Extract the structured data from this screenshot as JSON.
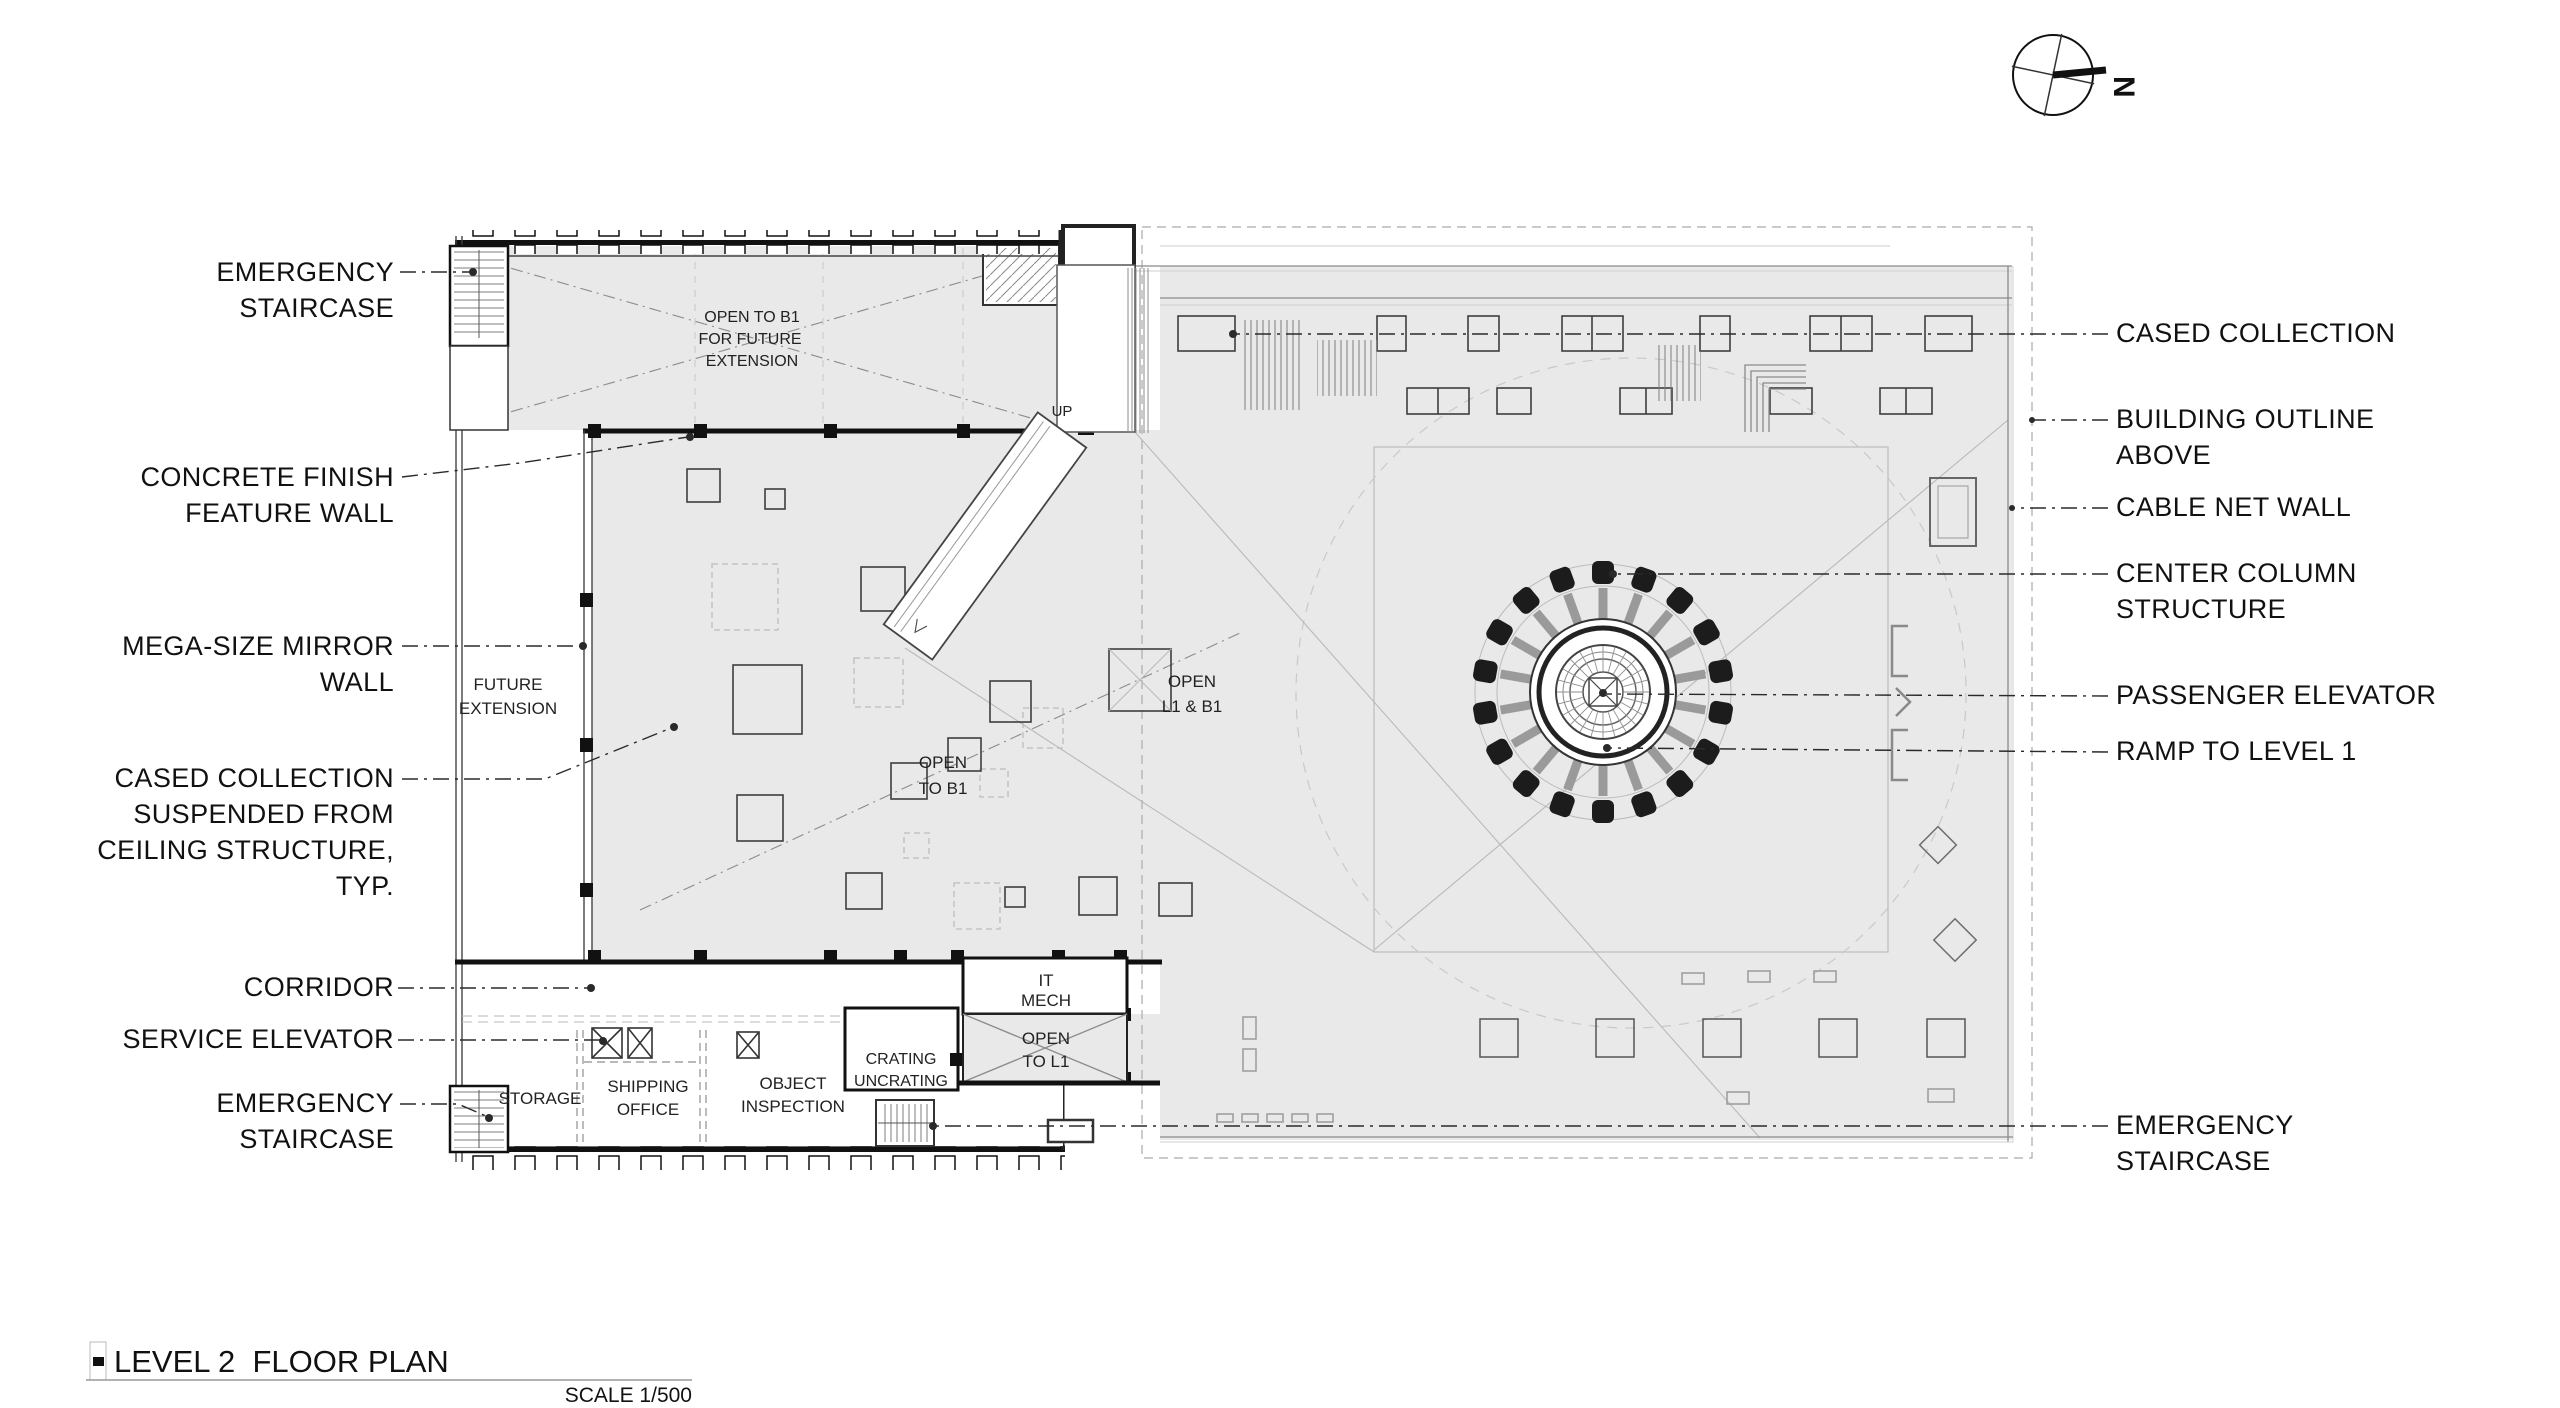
{
  "drawing": {
    "title": "LEVEL 2  FLOOR PLAN",
    "scale_label": "SCALE 1/500",
    "compass": {
      "north_letter": "N"
    }
  },
  "colors": {
    "wall": "#111111",
    "gray": "#e9e9e9",
    "leader": "#2a2a2a",
    "light": "#bbbbbb",
    "text": "#111111"
  },
  "labels": {
    "left": [
      {
        "id": "emergency-staircase-top",
        "lines": [
          "EMERGENCY",
          "STAIRCASE"
        ]
      },
      {
        "id": "concrete-finish-feature-wall",
        "lines": [
          "CONCRETE FINISH",
          "FEATURE WALL"
        ]
      },
      {
        "id": "mega-size-mirror-wall",
        "lines": [
          "MEGA-SIZE MIRROR",
          "WALL"
        ]
      },
      {
        "id": "cased-collection-suspended",
        "lines": [
          "CASED COLLECTION",
          "SUSPENDED FROM",
          "CEILING STRUCTURE,",
          "TYP."
        ]
      },
      {
        "id": "corridor",
        "lines": [
          "CORRIDOR"
        ]
      },
      {
        "id": "service-elevator",
        "lines": [
          "SERVICE ELEVATOR"
        ]
      },
      {
        "id": "emergency-staircase-bottom",
        "lines": [
          "EMERGENCY",
          "STAIRCASE"
        ]
      }
    ],
    "right": [
      {
        "id": "cased-collection",
        "lines": [
          "CASED COLLECTION"
        ]
      },
      {
        "id": "building-outline-above",
        "lines": [
          "BUILDING OUTLINE",
          "ABOVE"
        ]
      },
      {
        "id": "cable-net-wall",
        "lines": [
          "CABLE NET WALL"
        ]
      },
      {
        "id": "center-column-structure",
        "lines": [
          "CENTER COLUMN",
          "STRUCTURE"
        ]
      },
      {
        "id": "passenger-elevator",
        "lines": [
          "PASSENGER ELEVATOR"
        ]
      },
      {
        "id": "ramp-to-level-1",
        "lines": [
          "RAMP TO LEVEL 1"
        ]
      },
      {
        "id": "emergency-staircase-right",
        "lines": [
          "EMERGENCY",
          "STAIRCASE"
        ]
      }
    ],
    "interior": {
      "open_to_b1_future": [
        "OPEN TO B1",
        "FOR FUTURE",
        "EXTENSION"
      ],
      "future_extension": [
        "FUTURE",
        "EXTENSION"
      ],
      "open_l1_b1": [
        "OPEN",
        "L1 & B1"
      ],
      "open_to_b1": [
        "OPEN",
        "TO B1"
      ],
      "it_mech": [
        "IT",
        "MECH"
      ],
      "open_to_l1": [
        "OPEN",
        "TO L1"
      ],
      "crating_uncrating": [
        "CRATING",
        "UNCRATING"
      ],
      "storage": "STORAGE",
      "shipping_office": [
        "SHIPPING",
        "OFFICE"
      ],
      "object_inspection": [
        "OBJECT",
        "INSPECTION"
      ],
      "up": "UP"
    }
  }
}
